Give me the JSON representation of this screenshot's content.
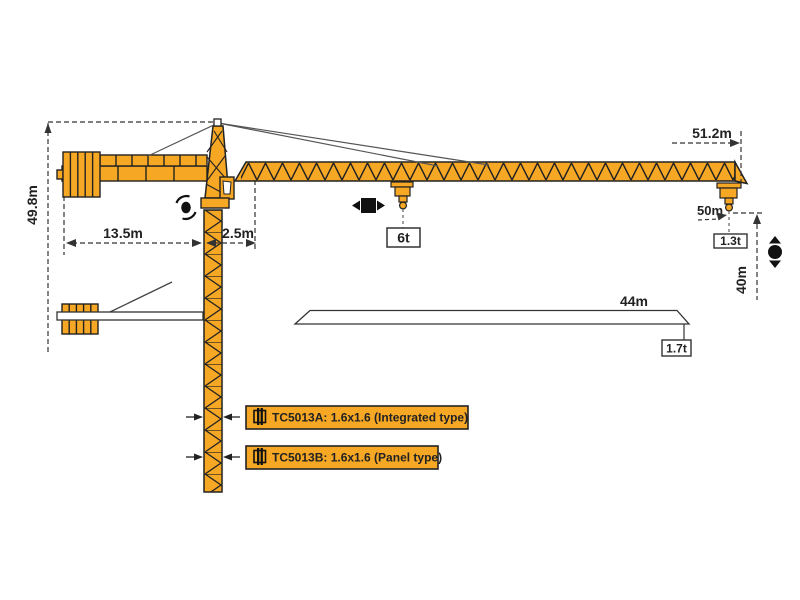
{
  "crane": {
    "dims": {
      "total_height": "49.8m",
      "counter_jib_length": "13.5m",
      "rear_offset": "2.5m",
      "working_radius": "51.2m",
      "trolley_travel": "50m",
      "hook_drop": "40m",
      "ground_jib_length": "44m"
    },
    "loads": {
      "max_capacity": "6t",
      "tip_capacity": "1.3t",
      "ground_jib_tip_load": "1.7t"
    },
    "labels": {
      "model_a": "TC5013A:  1.6x1.6  (Integrated type)",
      "model_b": "TC5013B:  1.6x1.6  (Panel type)"
    },
    "colors": {
      "crane_orange": "#F6A724",
      "outline": "#2b2b2b",
      "dimension_line": "#333333"
    }
  }
}
